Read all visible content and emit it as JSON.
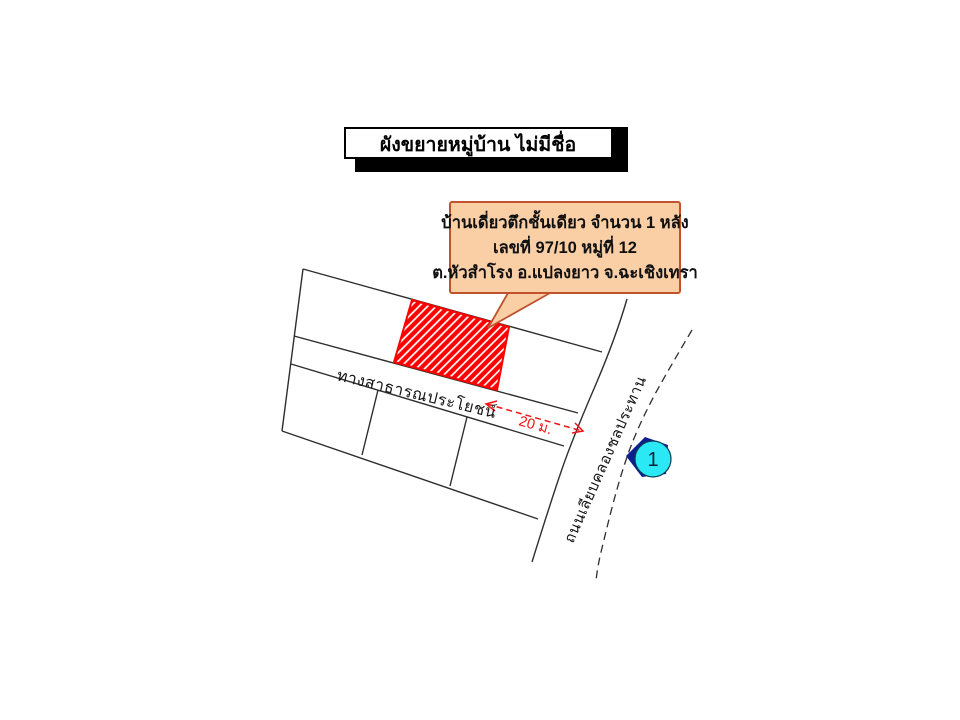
{
  "title_box": {
    "text": "ผังขยายหมู่บ้าน ไม่มีชื่อ"
  },
  "callout": {
    "line1": "บ้านเดี่ยวตึกชั้นเดียว จำนวน 1 หลัง",
    "line2": "เลขที่ 97/10 หมู่ที่ 12",
    "line3": "ต.หัวสำโรง อ.แปลงยาว จ.ฉะเชิงเทรา"
  },
  "plan": {
    "road_label": "ทางสาธารณประโยชน์",
    "canal_road_label": "ถนนเลียบคลองชลประทาน",
    "dimension_label": "20 ม.",
    "marker": {
      "number": "1"
    }
  },
  "colors": {
    "highlight_red": "#ff0000",
    "dimension_red": "#f01414",
    "callout_fill": "#fbcfa6",
    "callout_border": "#c0522d",
    "marker_fill": "#2be9f4",
    "marker_arrow": "#0d1f8e",
    "line_black": "#2e2e2e"
  }
}
